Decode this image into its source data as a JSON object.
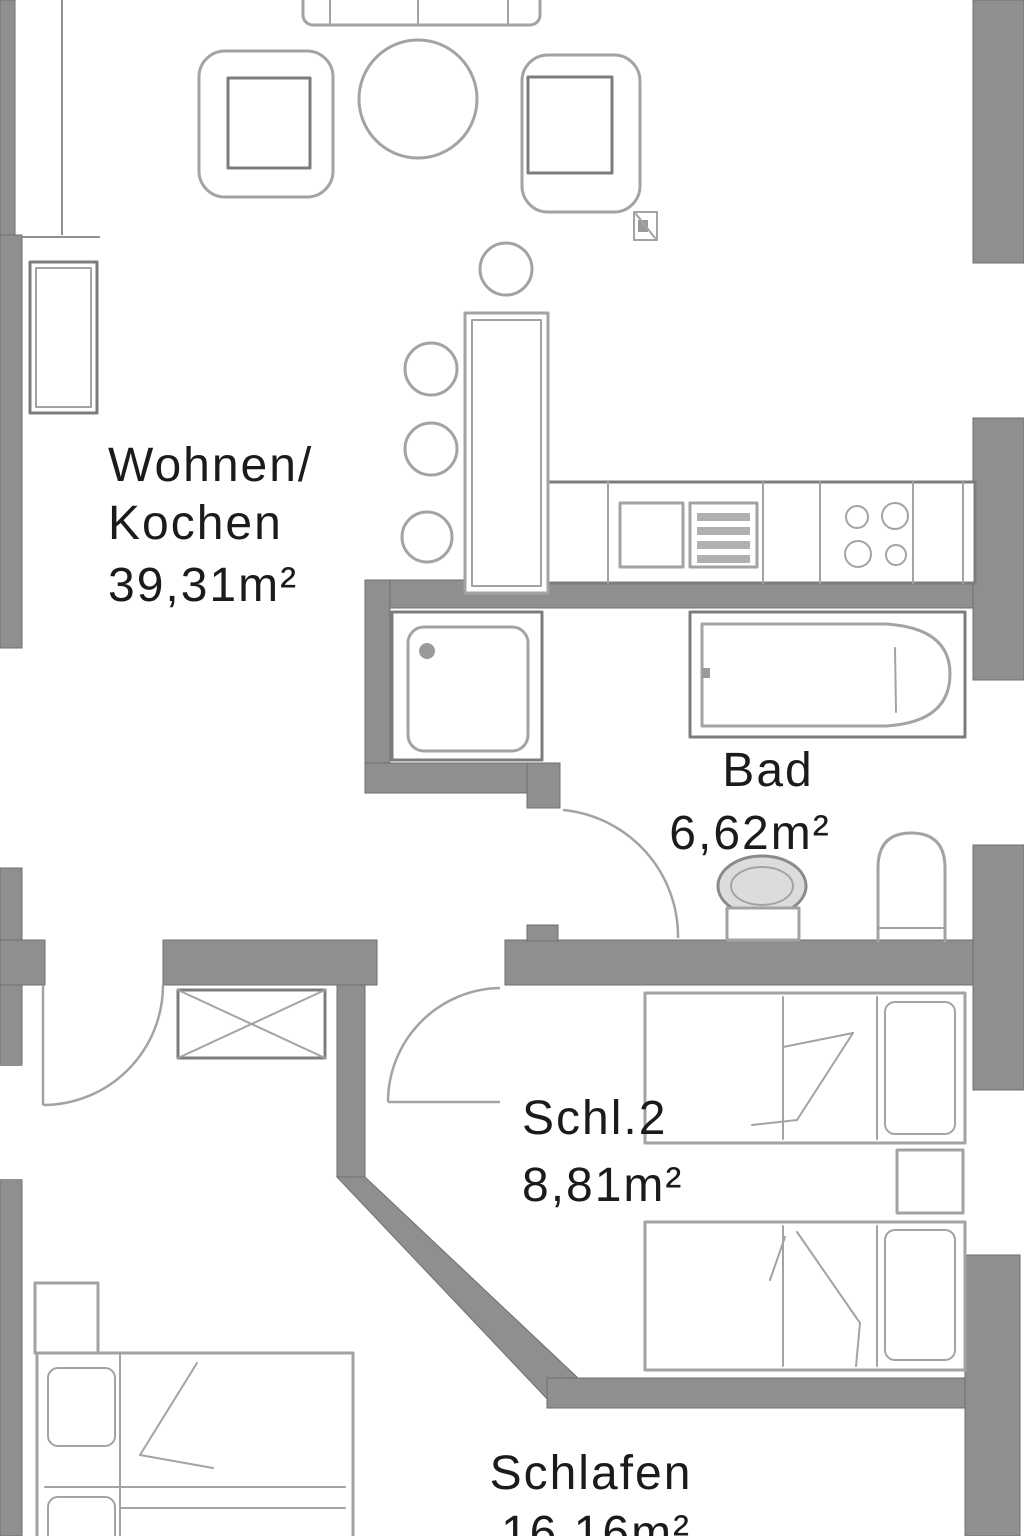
{
  "rooms": {
    "living": {
      "name": "Wohnen/",
      "name2": "Kochen",
      "area": "39,31m²"
    },
    "bath": {
      "name": "Bad",
      "area": "6,62m²"
    },
    "bedroom2": {
      "name": "Schl.2",
      "area": "8,81m²"
    },
    "bedroom1": {
      "name": "Schlafen",
      "area": "16,16m²"
    }
  },
  "colors": {
    "wall": "#8f8f8f",
    "wall_edge": "#6f6f6f",
    "line": "#a3a3a3",
    "line_dark": "#7c7c7c",
    "text": "#1b1b1b",
    "background": "#ffffff"
  }
}
